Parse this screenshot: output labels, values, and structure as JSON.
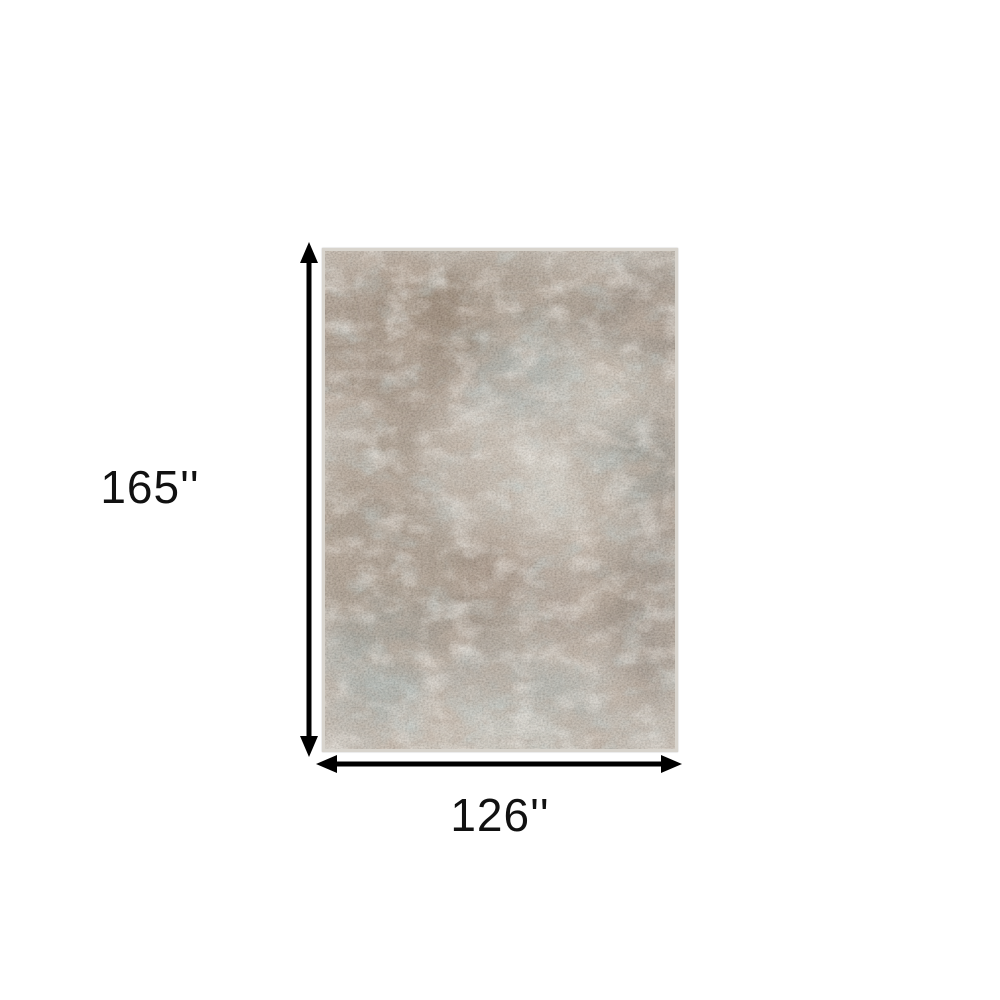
{
  "diagram": {
    "height_label": "165''",
    "width_label": "126''",
    "height_value_inches": 165,
    "width_value_inches": 126
  },
  "palette": {
    "background": "#ffffff",
    "arrow_color": "#000000",
    "label_text_color": "#111111",
    "rug_base": "#c2bbb1",
    "rug_brown": "#7d654f",
    "rug_dark_brown": "#6a5748",
    "rug_gray": "#9b948a",
    "rug_teal": "#869c9a",
    "rug_cream": "#ded9cf",
    "rug_border": "#d8d4cd"
  }
}
